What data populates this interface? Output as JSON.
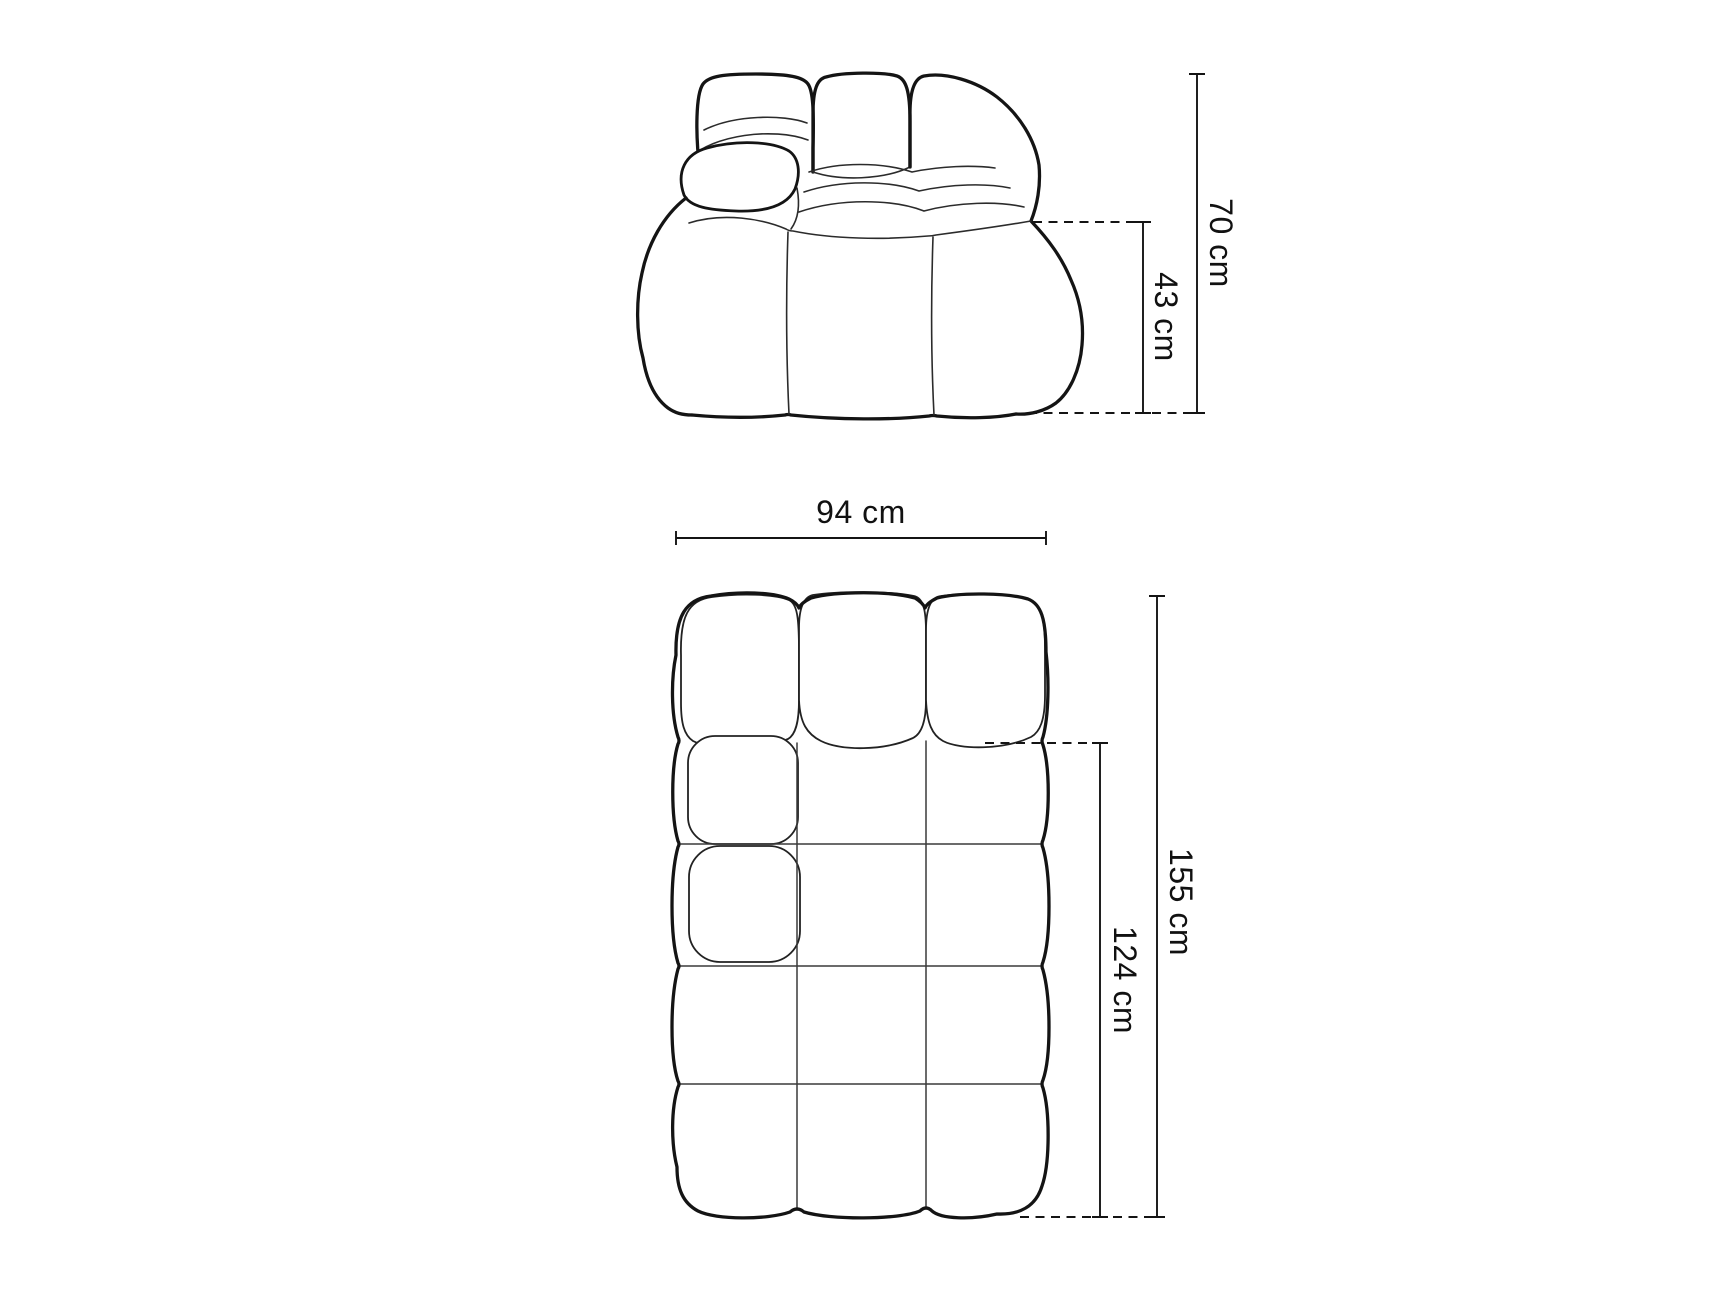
{
  "page": {
    "background": "#ffffff",
    "line_color": "#141414",
    "content": "sofa-module-dimension-drawing",
    "unit": "cm"
  },
  "front_view": {
    "title": "sofa-front-elevation",
    "dimensions": {
      "total_height": {
        "label": "70 cm",
        "value": 70,
        "unit": "cm",
        "orientation": "vertical"
      },
      "seat_height": {
        "label": "43 cm",
        "value": 43,
        "unit": "cm",
        "orientation": "vertical"
      }
    }
  },
  "top_view": {
    "title": "sofa-top-plan",
    "dimensions": {
      "width": {
        "label": "94 cm",
        "value": 94,
        "unit": "cm",
        "orientation": "horizontal"
      },
      "total_depth": {
        "label": "155 cm",
        "value": 155,
        "unit": "cm",
        "orientation": "vertical"
      },
      "seat_depth": {
        "label": "124 cm",
        "value": 124,
        "unit": "cm",
        "orientation": "vertical"
      }
    }
  }
}
